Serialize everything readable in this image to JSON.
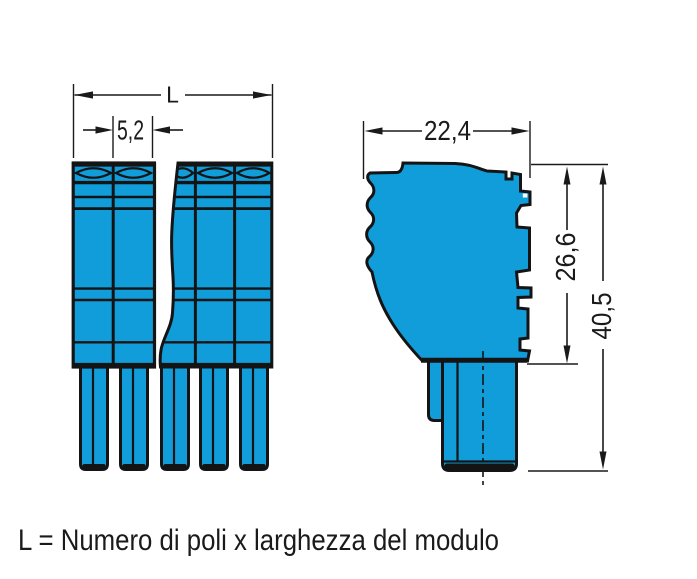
{
  "drawing": {
    "caption": "L = Numero di poli x larghezza del modulo",
    "dimensions": {
      "overall_width_label": "L",
      "pole_width": "5,2",
      "depth": "22,4",
      "body_height": "26,6",
      "total_height": "40,5"
    },
    "colors": {
      "body_blue": "#119dda",
      "line": "#141414",
      "background": "#ffffff"
    }
  }
}
